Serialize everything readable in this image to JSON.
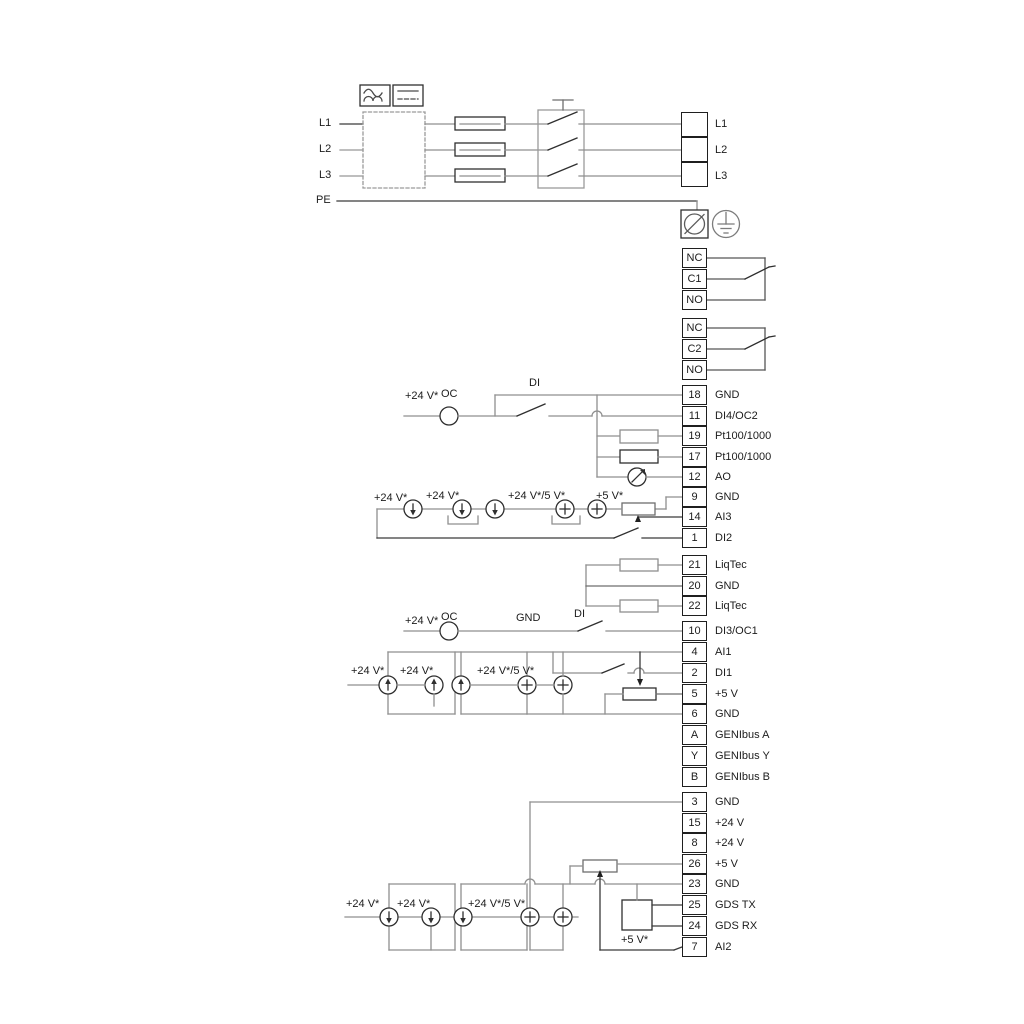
{
  "input_lines": {
    "l1": "L1",
    "l2": "L2",
    "l3": "L3",
    "pe": "PE"
  },
  "blocks": {
    "power": [
      {
        "label": "L1"
      },
      {
        "label": "L2"
      },
      {
        "label": "L3"
      }
    ],
    "relay1": [
      {
        "id": "NC"
      },
      {
        "id": "C1"
      },
      {
        "id": "NO"
      }
    ],
    "relay2": [
      {
        "id": "NC"
      },
      {
        "id": "C2"
      },
      {
        "id": "NO"
      }
    ],
    "a": [
      {
        "id": "18",
        "label": "GND"
      },
      {
        "id": "11",
        "label": "DI4/OC2"
      },
      {
        "id": "19",
        "label": "Pt100/1000"
      },
      {
        "id": "17",
        "label": "Pt100/1000"
      },
      {
        "id": "12",
        "label": "AO"
      },
      {
        "id": "9",
        "label": "GND"
      },
      {
        "id": "14",
        "label": "AI3"
      },
      {
        "id": "1",
        "label": "DI2"
      }
    ],
    "liqtec": [
      {
        "id": "21",
        "label": "LiqTec"
      },
      {
        "id": "20",
        "label": "GND"
      },
      {
        "id": "22",
        "label": "LiqTec"
      }
    ],
    "b": [
      {
        "id": "10",
        "label": "DI3/OC1"
      },
      {
        "id": "4",
        "label": "AI1"
      },
      {
        "id": "2",
        "label": "DI1"
      },
      {
        "id": "5",
        "label": "+5 V"
      },
      {
        "id": "6",
        "label": "GND"
      },
      {
        "id": "A",
        "label": "GENIbus A"
      },
      {
        "id": "Y",
        "label": "GENIbus Y"
      },
      {
        "id": "B",
        "label": "GENIbus B"
      }
    ],
    "c": [
      {
        "id": "3",
        "label": "GND"
      },
      {
        "id": "15",
        "label": "+24 V"
      },
      {
        "id": "8",
        "label": "+24 V"
      },
      {
        "id": "26",
        "label": "+5 V"
      },
      {
        "id": "23",
        "label": "GND"
      },
      {
        "id": "25",
        "label": "GDS TX"
      },
      {
        "id": "24",
        "label": "GDS RX"
      },
      {
        "id": "7",
        "label": "AI2"
      }
    ]
  },
  "labels": {
    "a_supply": "+24 V*",
    "a_oc": "OC",
    "a_di": "DI",
    "a_s1": "+24 V*",
    "a_s2": "+24 V*",
    "a_s3": "+24 V*/5 V*",
    "a_s4": "+5 V*",
    "b_supply": "+24 V*",
    "b_oc": "OC",
    "b_gnd": "GND",
    "b_di": "DI",
    "b_s1": "+24 V*",
    "b_s2": "+24 V*",
    "b_s3": "+24 V*/5 V*",
    "c_s1": "+24 V*",
    "c_s2": "+24 V*",
    "c_s3": "+24 V*/5 V*",
    "c_gds": "+5 V*"
  },
  "icons": {
    "ac_symbol": "sine-wave",
    "dc_symbol": "solid-over-dashed-line",
    "earth_symbol": "protective-earth",
    "screw_terminal": "circle-with-slash"
  },
  "colors": {
    "wire_dark": "#3a3a3a",
    "wire_gray": "#979797",
    "text": "#1c1c1c"
  }
}
